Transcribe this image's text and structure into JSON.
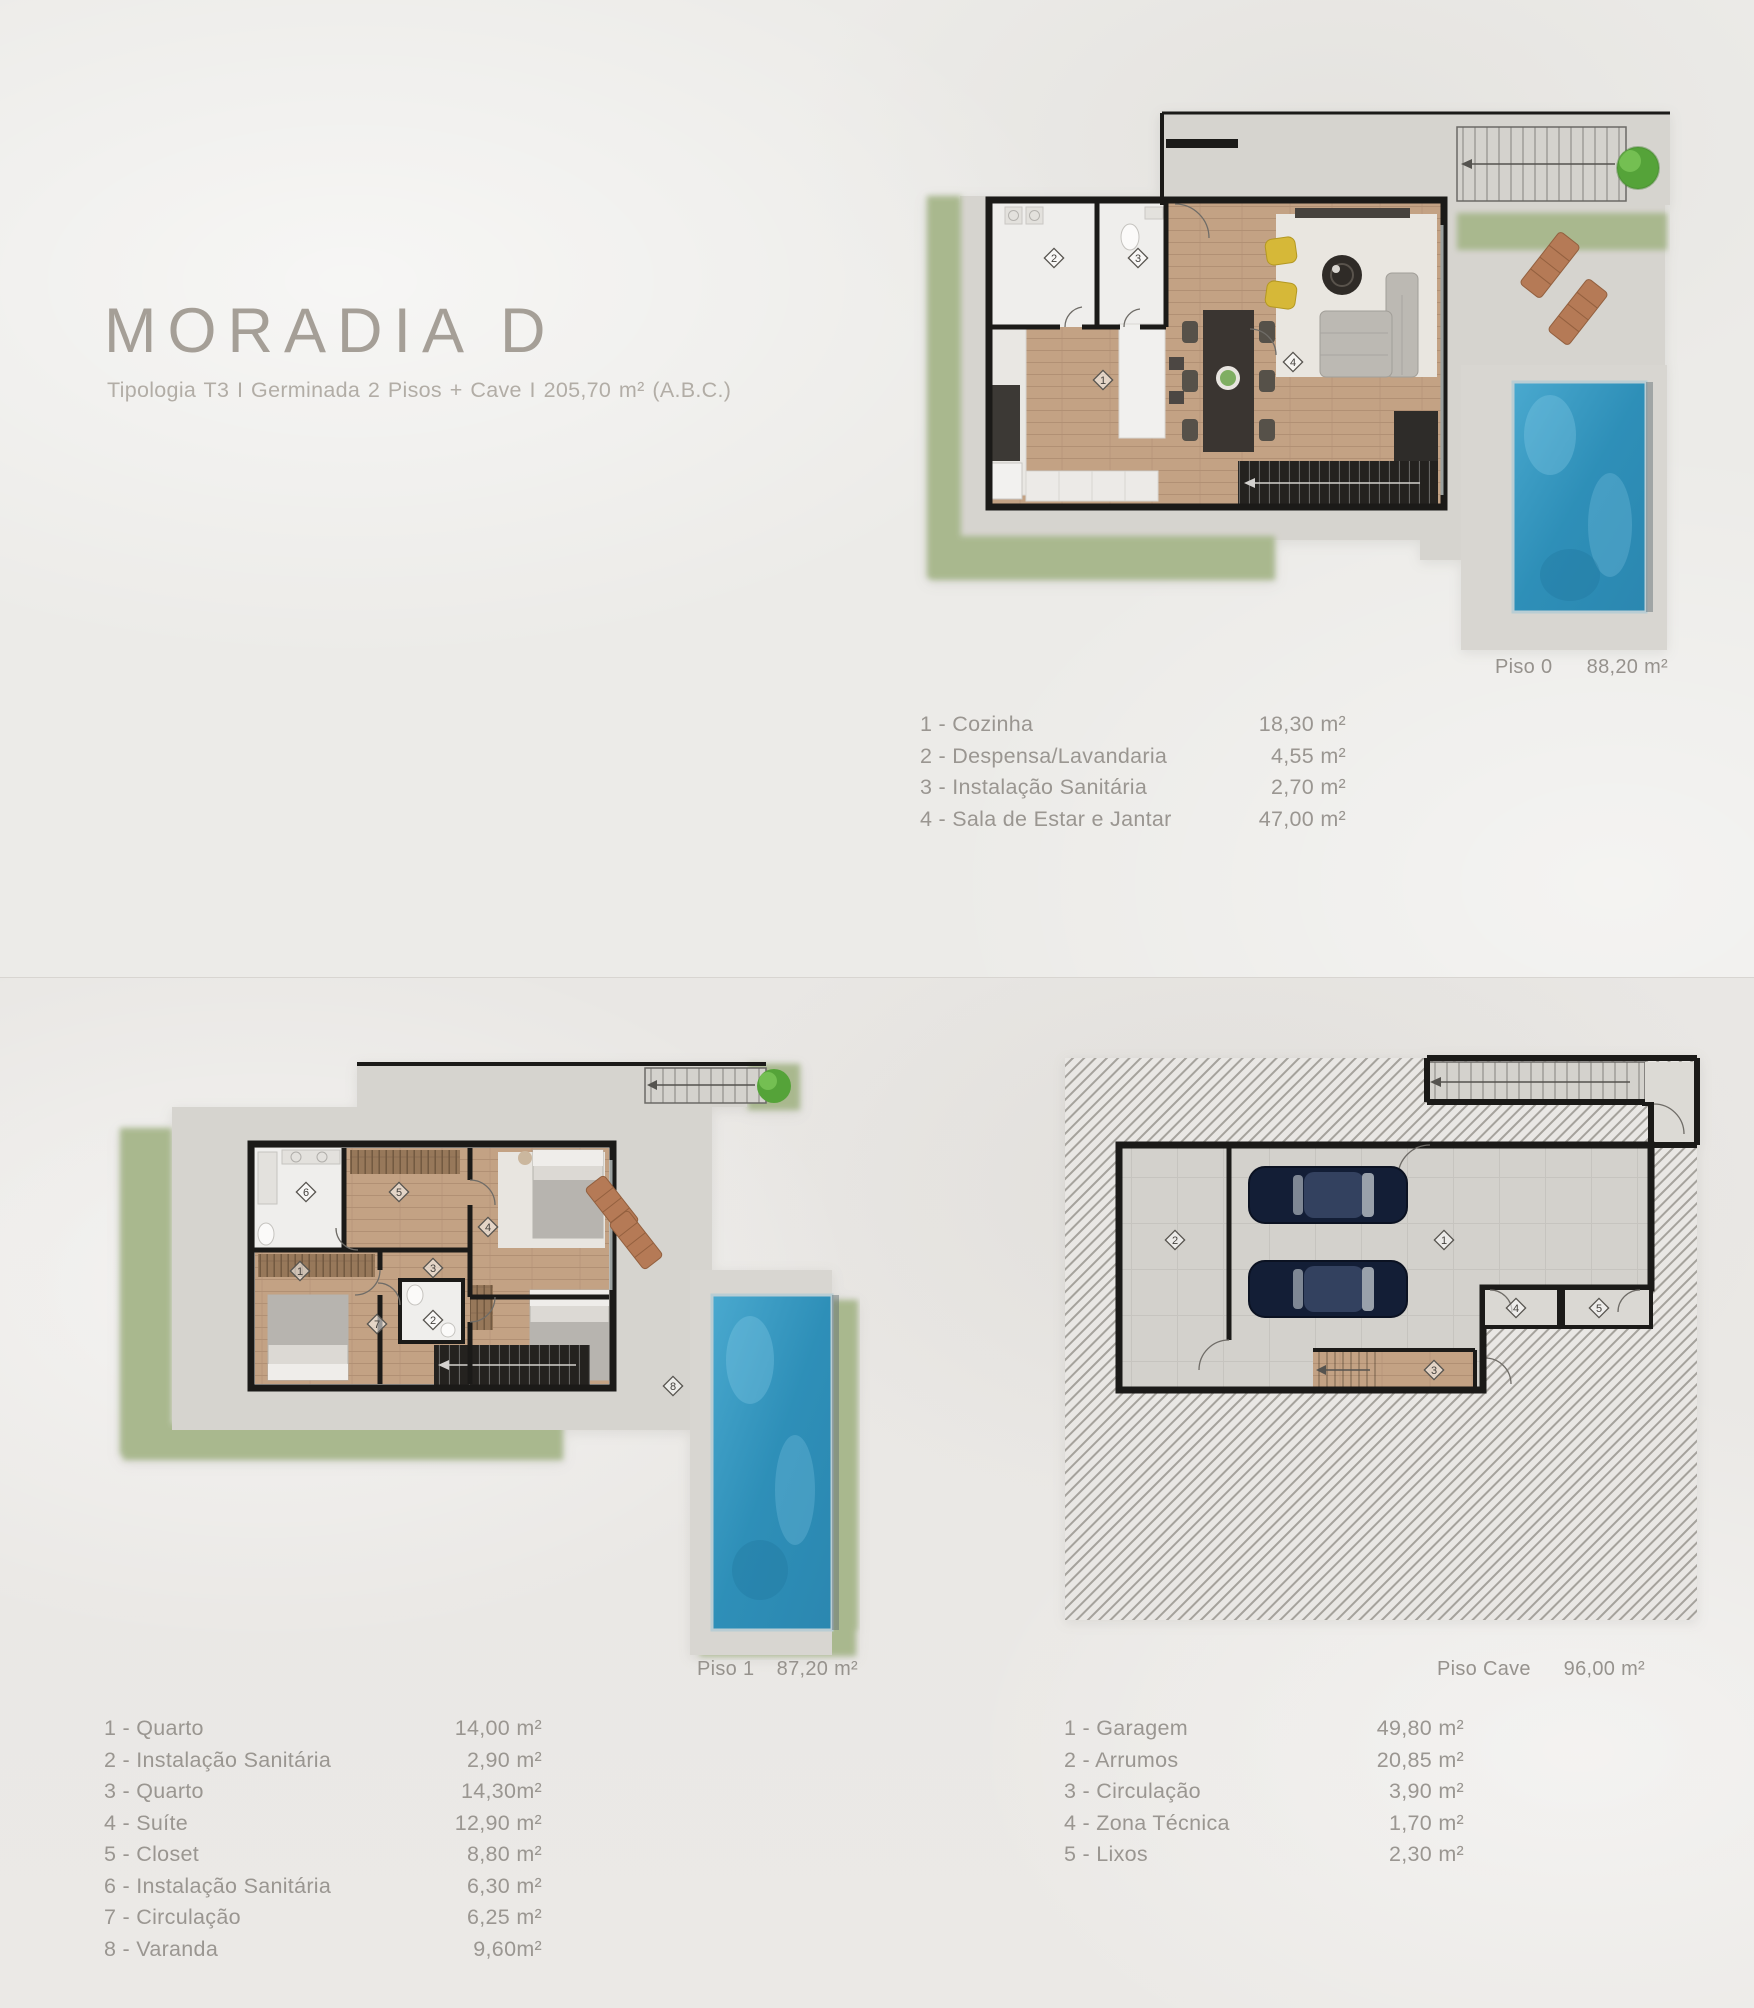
{
  "page": {
    "title": "MORADIA D",
    "subtitle": "Tipologia T3  I  Germinada 2 Pisos + Cave  I  205,70 m² (A.B.C.)",
    "legend_separator": " - "
  },
  "palette": {
    "background": "#ecebe8",
    "background_lower": "#e9e7e4",
    "garden_green": "#a9b88e",
    "patio_gray": "#d6d4cf",
    "wood_floor": "#c2a184",
    "wall_black": "#1b1a18",
    "pool_blue": "#2e8fb8",
    "lounger_terracotta": "#b57a56",
    "car_navy": "#16223d",
    "tree_green": "#57a63b",
    "text_gray": "#9a9691",
    "title_gray": "#a59f97"
  },
  "floors": [
    {
      "id": "piso0",
      "label": "Piso 0",
      "area": "88,20 m²",
      "legend": [
        {
          "num": "1",
          "name": "Cozinha",
          "area": "18,30 m²"
        },
        {
          "num": "2",
          "name": "Despensa/Lavandaria",
          "area": "4,55 m²"
        },
        {
          "num": "3",
          "name": "Instalação Sanitária",
          "area": "2,70 m²"
        },
        {
          "num": "4",
          "name": "Sala de Estar e Jantar",
          "area": "47,00 m²"
        }
      ],
      "markers": [
        {
          "n": "1",
          "x": 383,
          "y": 305
        },
        {
          "n": "2",
          "x": 334,
          "y": 183
        },
        {
          "n": "3",
          "x": 418,
          "y": 183
        },
        {
          "n": "4",
          "x": 573,
          "y": 287
        }
      ]
    },
    {
      "id": "piso1",
      "label": "Piso 1",
      "area": "87,20 m²",
      "legend": [
        {
          "num": "1",
          "name": "Quarto",
          "area": "14,00 m²"
        },
        {
          "num": "2",
          "name": "Instalação Sanitária",
          "area": "2,90 m²"
        },
        {
          "num": "3",
          "name": "Quarto",
          "area": "14,30m²"
        },
        {
          "num": "4",
          "name": "Suíte",
          "area": "12,90 m²"
        },
        {
          "num": "5",
          "name": "Closet",
          "area": "8,80 m²"
        },
        {
          "num": "6",
          "name": "Instalação Sanitária",
          "area": "6,30 m²"
        },
        {
          "num": "7",
          "name": "Circulação",
          "area": "6,25 m²"
        },
        {
          "num": "8",
          "name": "Varanda",
          "area": "9,60m²"
        }
      ],
      "markers": [
        {
          "n": "1",
          "x": 200,
          "y": 231
        },
        {
          "n": "2",
          "x": 333,
          "y": 280
        },
        {
          "n": "3",
          "x": 333,
          "y": 228
        },
        {
          "n": "4",
          "x": 388,
          "y": 187
        },
        {
          "n": "5",
          "x": 299,
          "y": 152
        },
        {
          "n": "6",
          "x": 206,
          "y": 152
        },
        {
          "n": "7",
          "x": 277,
          "y": 284
        },
        {
          "n": "8",
          "x": 573,
          "y": 346
        }
      ]
    },
    {
      "id": "cave",
      "label": "Piso Cave",
      "area": "96,00 m²",
      "legend": [
        {
          "num": "1",
          "name": "Garagem",
          "area": "49,80 m²"
        },
        {
          "num": "2",
          "name": "Arrumos",
          "area": "20,85 m²"
        },
        {
          "num": "3",
          "name": "Circulação",
          "area": "3,90 m²"
        },
        {
          "num": "4",
          "name": "Zona Técnica",
          "area": "1,70 m²"
        },
        {
          "num": "5",
          "name": "Lixos",
          "area": "2,30 m²"
        }
      ],
      "markers": [
        {
          "n": "1",
          "x": 404,
          "y": 200
        },
        {
          "n": "2",
          "x": 135,
          "y": 200
        },
        {
          "n": "3",
          "x": 394,
          "y": 330
        },
        {
          "n": "4",
          "x": 476,
          "y": 268
        },
        {
          "n": "5",
          "x": 559,
          "y": 268
        }
      ]
    }
  ]
}
